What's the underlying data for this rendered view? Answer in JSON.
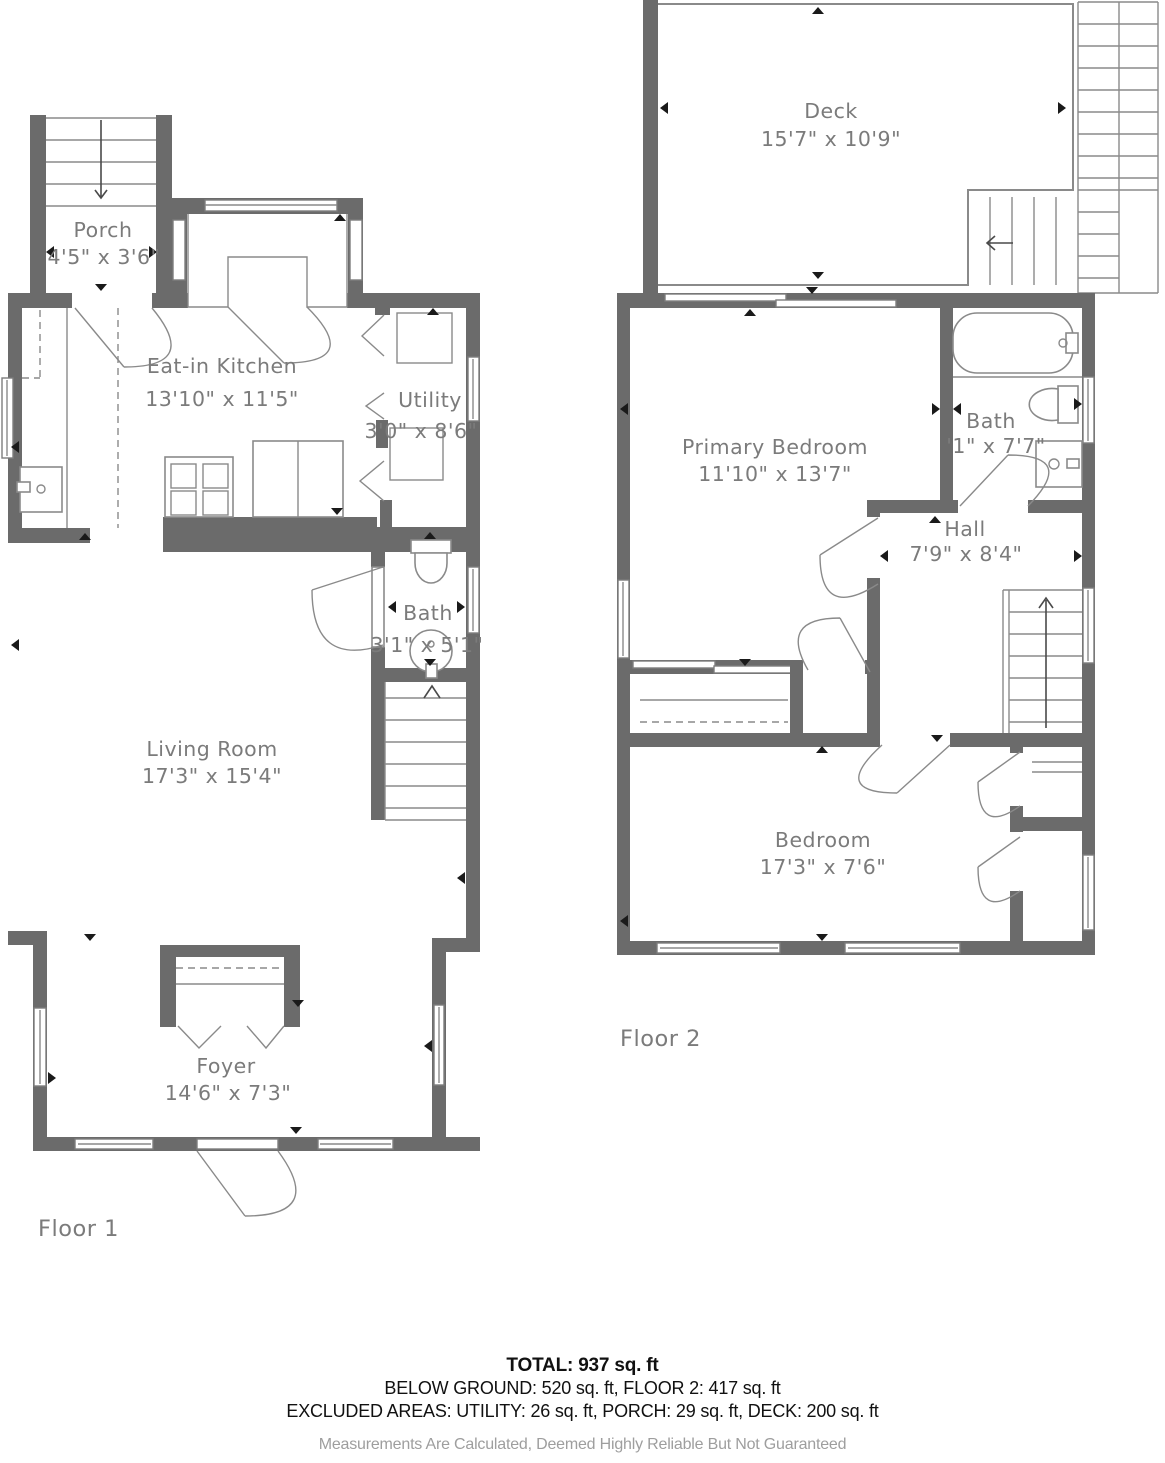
{
  "floor1": {
    "label": "Floor 1",
    "rooms": {
      "porch": {
        "name": "Porch",
        "dims": "4'5\" x 3'6\""
      },
      "kitchen": {
        "name": "Eat-in Kitchen",
        "dims": "13'10\" x 11'5\""
      },
      "utility": {
        "name": "Utility",
        "dims": "3'0\" x 8'6\""
      },
      "bath": {
        "name": "Bath",
        "dims": "3'1\" x 5'1\""
      },
      "living": {
        "name": "Living Room",
        "dims": "17'3\" x 15'4\""
      },
      "foyer": {
        "name": "Foyer",
        "dims": "14'6\" x 7'3\""
      }
    }
  },
  "floor2": {
    "label": "Floor 2",
    "rooms": {
      "deck": {
        "name": "Deck",
        "dims": "15'7\" x 10'9\""
      },
      "primary_bedroom": {
        "name": "Primary Bedroom",
        "dims": "11'10\" x 13'7\""
      },
      "bath": {
        "name": "Bath",
        "dims": "'1\" x 7'7\""
      },
      "hall": {
        "name": "Hall",
        "dims": "7'9\" x 8'4\""
      },
      "bedroom": {
        "name": "Bedroom",
        "dims": "17'3\" x 7'6\""
      }
    }
  },
  "summary": {
    "total": "TOTAL: 937 sq. ft",
    "floors": "BELOW GROUND: 520 sq. ft, FLOOR 2: 417 sq. ft",
    "excluded": "EXCLUDED AREAS: UTILITY: 26 sq. ft, PORCH: 29 sq. ft, DECK: 200 sq. ft",
    "disclaimer": "Measurements Are Calculated, Deemed Highly Reliable But Not Guaranteed"
  },
  "colors": {
    "wall": "#6b6b6b",
    "line": "#8a8a8a",
    "label": "#7b7b7b",
    "text": "#111111",
    "disclaimer": "#9e9e9e"
  }
}
